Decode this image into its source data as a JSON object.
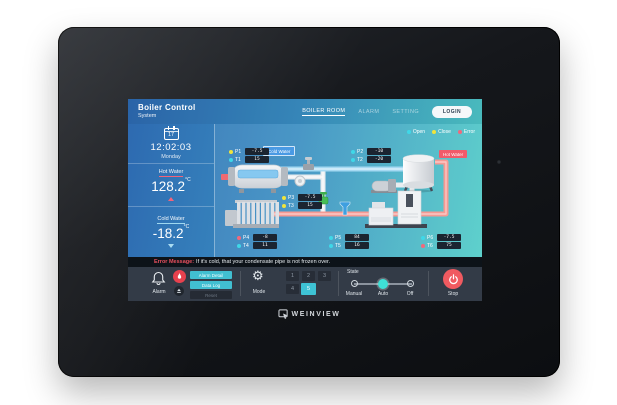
{
  "device": {
    "brand": "WEINVIEW"
  },
  "header": {
    "title": "Boiler Control",
    "subtitle": "System",
    "nav": [
      {
        "label": "BOILER ROOM",
        "active": true
      },
      {
        "label": "ALARM",
        "active": false
      },
      {
        "label": "SETTING",
        "active": false
      }
    ],
    "login_label": "LOGIN"
  },
  "sidebar": {
    "date_day": "17",
    "time": "12:02:03",
    "weekday": "Monday",
    "hot": {
      "label": "Hot Water",
      "value": "128.2",
      "unit": "°C"
    },
    "cold": {
      "label": "Cold Water",
      "value": "-18.2",
      "unit": "°C"
    }
  },
  "legend": [
    {
      "label": "Open",
      "color": "#3fd8e8"
    },
    {
      "label": "Close",
      "color": "#f0e43c"
    },
    {
      "label": "Error",
      "color": "#f2697c"
    }
  ],
  "diagram": {
    "cold_water_tag": "Cold Water",
    "hot_water_tag": "Hot Water",
    "sensors": {
      "p1": {
        "name": "P1",
        "value": "-7.5"
      },
      "t1": {
        "name": "T1",
        "value": "15"
      },
      "p2": {
        "name": "P2",
        "value": "-10"
      },
      "t2": {
        "name": "T2",
        "value": "-20"
      },
      "p3": {
        "name": "P3",
        "value": "-7.5"
      },
      "t3": {
        "name": "T3",
        "value": "15"
      },
      "p4": {
        "name": "P4",
        "value": "-8"
      },
      "t4": {
        "name": "T4",
        "value": "11"
      },
      "p5": {
        "name": "P5",
        "value": "84"
      },
      "t5": {
        "name": "T5",
        "value": "16"
      },
      "p6": {
        "name": "P6",
        "value": "-7.5"
      },
      "t6": {
        "name": "T6",
        "value": "75"
      }
    }
  },
  "error_bar": {
    "prefix": "Error Message:",
    "message": "If it's cold, that your condensate pipe is not frozen over."
  },
  "controls": {
    "alarm": {
      "label": "Alarm",
      "detail_button": "Alarm Detail",
      "log_button": "Data Log",
      "reset_button": "Reset"
    },
    "mode": {
      "label": "Mode",
      "numbers": [
        "1",
        "2",
        "3",
        "4",
        "5"
      ],
      "active": "5"
    },
    "state": {
      "label": "State",
      "options": [
        "Manual",
        "Auto",
        "Off"
      ],
      "selected": "Auto"
    },
    "stop": {
      "label": "Stop"
    }
  },
  "colors": {
    "open": "#3fd8e8",
    "close": "#f0e43c",
    "error": "#f2697c",
    "accent_cyan": "#41bfd1",
    "stop_red": "#f05a60",
    "hot_tag": "#f25a6a",
    "cold_tag": "#4a9ae4"
  }
}
